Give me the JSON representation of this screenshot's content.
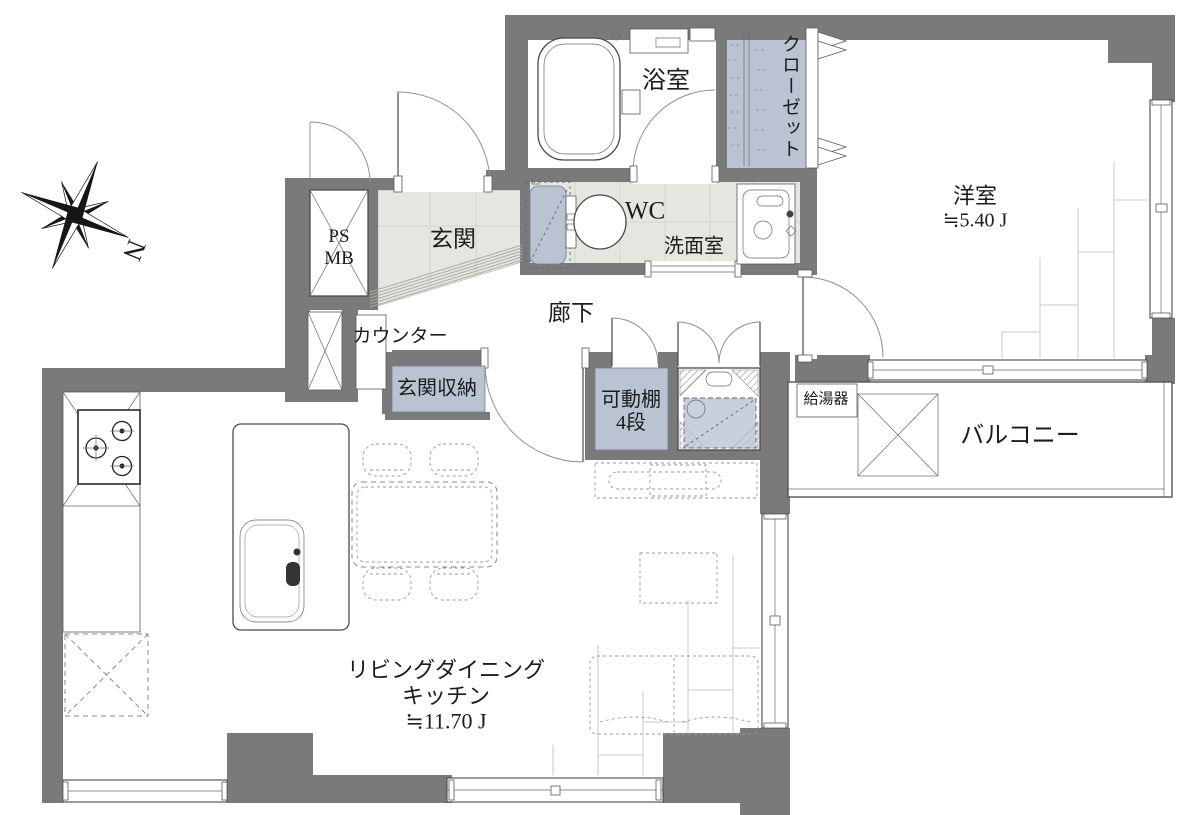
{
  "compass": {
    "label": "N"
  },
  "rooms": {
    "bathroom": {
      "label": "浴室"
    },
    "closet": {
      "label": "クローゼット"
    },
    "western_room": {
      "label": "洋室",
      "size": "≒5.40 J"
    },
    "utility_shaft": {
      "line1": "PS",
      "line2": "MB"
    },
    "entrance": {
      "label": "玄関"
    },
    "wc": {
      "label": "WC"
    },
    "washroom": {
      "label": "洗面室"
    },
    "hallway": {
      "label": "廊下"
    },
    "counter": {
      "label": "カウンター"
    },
    "entrance_storage": {
      "label": "玄関収納"
    },
    "movable_shelf": {
      "line1": "可動棚",
      "line2": "4段"
    },
    "water_heater": {
      "label": "給湯器"
    },
    "balcony": {
      "label": "バルコニー"
    },
    "ldk": {
      "line1": "リビングダイニング",
      "line2": "キッチン",
      "size": "≒11.70 J"
    }
  },
  "colors": {
    "wall": "#7a7a7a",
    "wet_floor": "#e4e6df",
    "fixture_blue": "#b9c3d1"
  }
}
